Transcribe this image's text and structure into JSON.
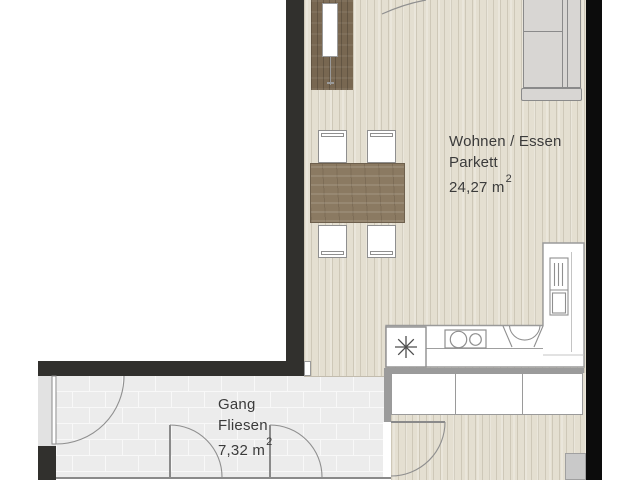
{
  "plan": {
    "type": "apartment-floor-plan",
    "rooms": {
      "living": {
        "name": "Wohnen / Essen",
        "flooring": "Parkett",
        "area_text": "24,27 m",
        "area_sup": "2"
      },
      "corridor": {
        "name": "Gang",
        "flooring": "Fliesen",
        "area_text": "7,32 m",
        "area_sup": "2"
      }
    },
    "furniture": [
      "wardrobe",
      "clothes-rail",
      "dining-table",
      "chair",
      "chair",
      "chair",
      "chair",
      "sofa",
      "kitchen-counter",
      "appliance-box-asterisk",
      "cooktop",
      "sink",
      "tall-cabinet",
      "closet-row",
      "utility-box"
    ],
    "doors": [
      "entrance-door-arc",
      "corridor-left-door",
      "corridor-bottom-door-1",
      "corridor-bottom-door-2",
      "bedroom-door"
    ],
    "palette": {
      "wall_dark": "#31302d",
      "wall_black": "#0c0c0c",
      "wall_light_gray": "#9b9b9b",
      "parquet": "#e4dfd1",
      "tile": "#ececec",
      "wardrobe_wood": "#786751",
      "table_wood": "#8b7a62",
      "sofa_gray": "#d8d6d3",
      "counter_white": "#ffffff",
      "line_gray": "#8f8f8f",
      "text": "#3b3b3b"
    }
  }
}
